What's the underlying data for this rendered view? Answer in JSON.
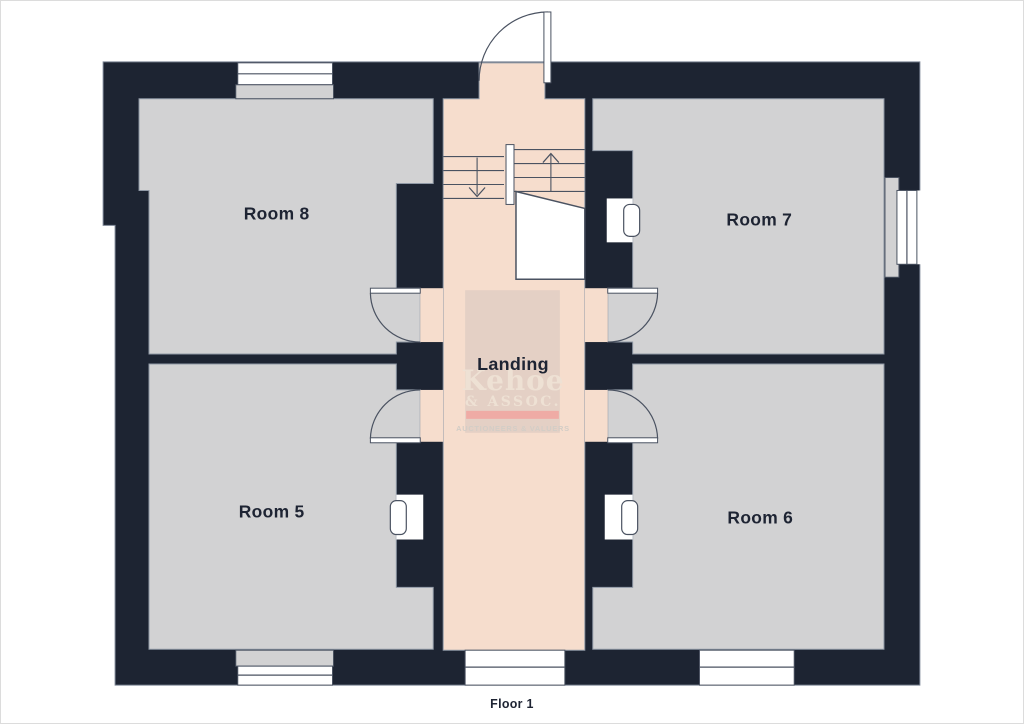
{
  "floorplan": {
    "floor_title": "Floor 1",
    "rooms": [
      {
        "id": "room8",
        "label": "Room 8"
      },
      {
        "id": "room7",
        "label": "Room 7"
      },
      {
        "id": "room5",
        "label": "Room 5"
      },
      {
        "id": "room6",
        "label": "Room 6"
      },
      {
        "id": "landing",
        "label": "Landing"
      }
    ],
    "stairs": {
      "up_arrow": "up",
      "down_arrow": "down"
    },
    "watermark": {
      "name": "Kehoe",
      "suffix": "& ASSOC.",
      "tagline": "AUCTIONEERS & VALUERS"
    },
    "colors": {
      "wall": "#1d2432",
      "wall_outline": "#7b8494",
      "room": "#d2d2d3",
      "room_outline": "#9099a6",
      "landing": "#f6ddcd",
      "symbol": "#4a5261",
      "label": "#1e2433",
      "watermark_box": "#e4d0c5",
      "watermark_text": "#eee1d4",
      "watermark_bar": "#efaba5",
      "watermark_tag": "#d3cdc6"
    }
  }
}
